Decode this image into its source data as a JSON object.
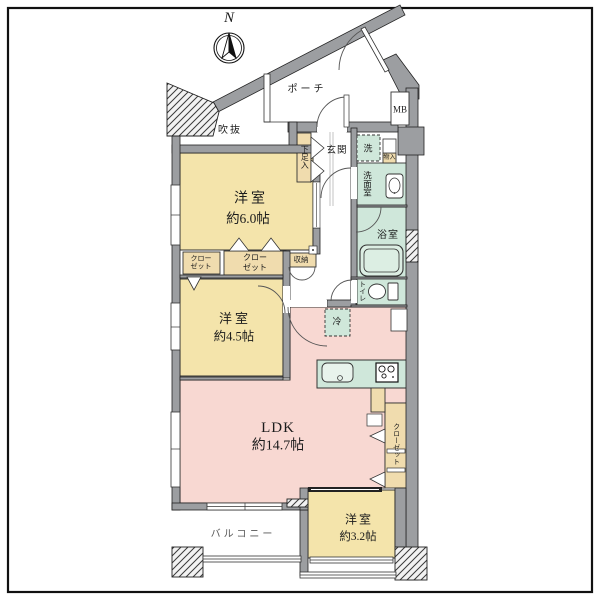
{
  "compass": {
    "north": "N"
  },
  "areas": {
    "porch": "ポーチ",
    "void": "吹抜",
    "meter_box": "MB",
    "entrance": "玄関",
    "shoe_cabinet": "下足入",
    "washer": "洗",
    "small_storage": "物入",
    "washroom": "洗面室",
    "bathroom": "浴室",
    "toilet": "トイレ",
    "fridge": "冷",
    "storage": "収納",
    "balcony": "バルコニー"
  },
  "rooms": {
    "bedroom_6": {
      "name": "洋室",
      "size": "約6.0帖"
    },
    "bedroom_45": {
      "name": "洋室",
      "size": "約4.5帖"
    },
    "ldk": {
      "name": "LDK",
      "size": "約14.7帖"
    },
    "bedroom_32": {
      "name": "洋室",
      "size": "約3.2帖"
    }
  },
  "closets": {
    "closet_a_line1": "クロー",
    "closet_a_line2": "ゼット",
    "closet_b_line1": "クロー",
    "closet_b_line2": "ゼット",
    "closet_c": "クローゼット"
  },
  "colors": {
    "room_yellow": "#f4e4ab",
    "ldk_pink": "#f8d8d2",
    "wet_green": "#cfe7da",
    "closet_tan": "#f0dcae",
    "wall_gray": "#9c9ea1"
  }
}
